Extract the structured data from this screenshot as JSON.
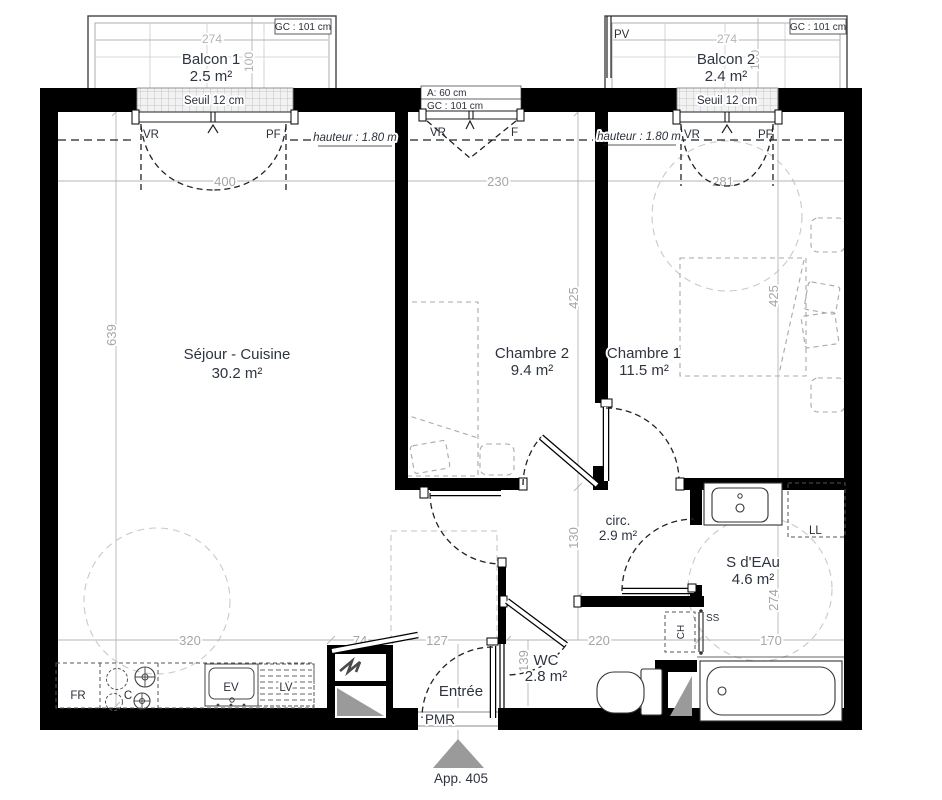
{
  "plan": {
    "apartment": "App. 405",
    "entrance_access": "PMR"
  },
  "rooms": {
    "sejour": {
      "name": "Séjour - Cuisine",
      "area": "30.2 m²"
    },
    "chambre2": {
      "name": "Chambre 2",
      "area": "9.4 m²"
    },
    "chambre1": {
      "name": "Chambre 1",
      "area": "11.5 m²"
    },
    "circ": {
      "name": "circ.",
      "area": "2.9 m²"
    },
    "sdeau": {
      "name": "S d'EAu",
      "area": "4.6 m²"
    },
    "wc": {
      "name": "WC",
      "area": "2.8 m²"
    },
    "entree": {
      "name": "Entrée"
    },
    "balcon1": {
      "name": "Balcon 1",
      "area": "2.5 m²"
    },
    "balcon2": {
      "name": "Balcon 2",
      "area": "2.4 m²"
    }
  },
  "openings": {
    "balcon1_window": {
      "left": "VR",
      "right": "PF",
      "sill": "Seuil 12 cm",
      "guard": "GC : 101 cm"
    },
    "balcon2_window": {
      "left": "VR",
      "right": "PF",
      "sill": "Seuil 12 cm",
      "guard": "GC : 101 cm",
      "screen": "PV"
    },
    "middle_window": {
      "left": "VR",
      "right": "F",
      "allege": "A: 60 cm",
      "guard": "GC : 101 cm"
    },
    "height_note_left": "hauteur : 1.80 m",
    "height_note_right": "hauteur : 1.80 m"
  },
  "equipment": {
    "fridge": "FR",
    "hob": "C",
    "sink": "EV",
    "dishwasher": "LV",
    "washer": "LL",
    "water_heater": "CH",
    "towel_rail": "SS"
  },
  "dimensions": {
    "balcon1_w": "274",
    "balcon1_d": "100",
    "balcon2_w": "274",
    "balcon2_d": "100",
    "sejour_w": "400",
    "chambre2_w": "230",
    "chambre1_w": "281",
    "sejour_h": "639",
    "chambre2_h": "425",
    "chambre1_h": "425",
    "circ_h": "130",
    "sdeau_h": "274",
    "wc_h": "139",
    "bottom": [
      "320",
      "74",
      "127",
      "220",
      "170"
    ]
  }
}
